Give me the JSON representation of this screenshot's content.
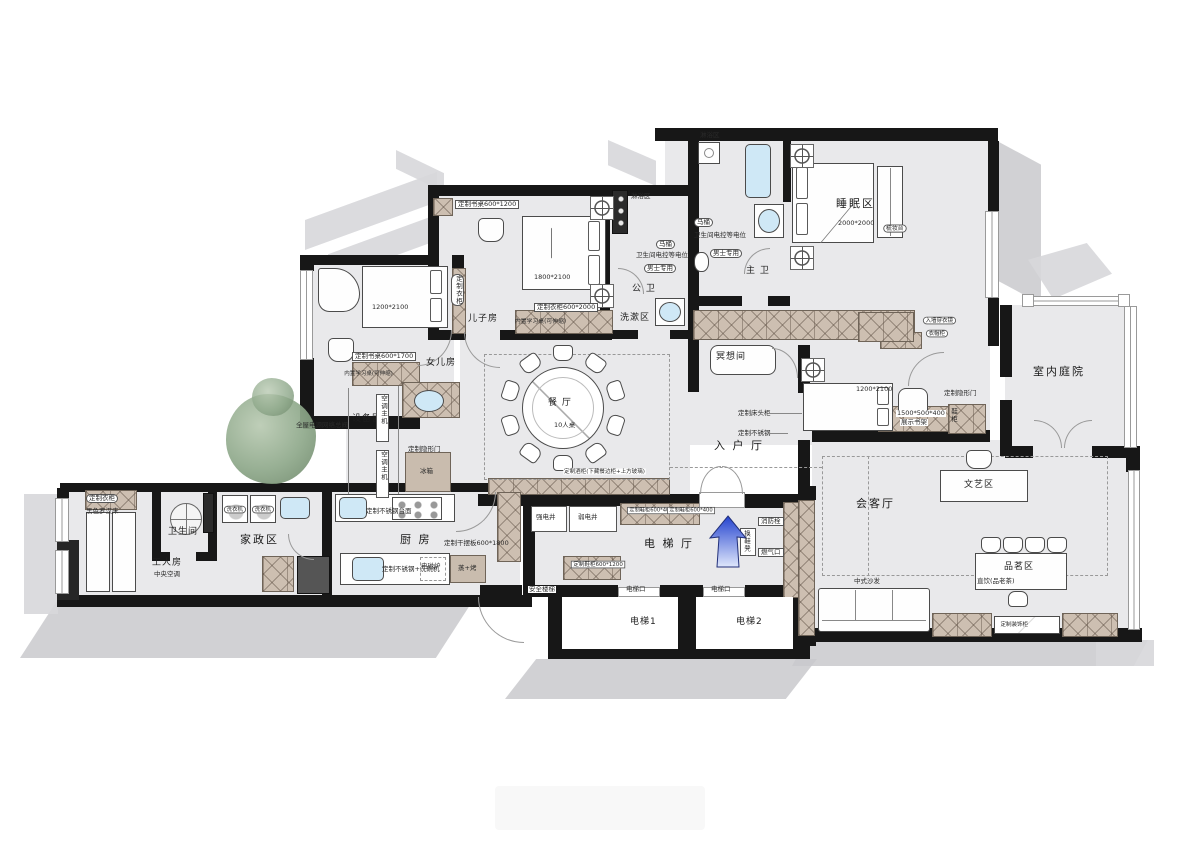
{
  "title": "户型平面布置图",
  "colors": {
    "wall": "#171717",
    "floor": "#e9e9eb",
    "shadow": "#c9c9cd",
    "cabinet_hatch": "#cdbfb1",
    "water_blue": "#cfe8f6",
    "tree_green": "#8ea88a",
    "arrow_blue": "#2443cf",
    "dash_line": "#999999"
  },
  "rooms": {
    "sleeping": {
      "label": "睡眠区",
      "dim": "2000*2000"
    },
    "master_bath": {
      "label": "主 卫"
    },
    "public_bath": {
      "label": "公 卫"
    },
    "wash": {
      "label": "洗漱区"
    },
    "son": {
      "label": "儿子房",
      "bed_dim": "1800*2100"
    },
    "daughter": {
      "label": "女儿房",
      "bed_dim": "1200*2100"
    },
    "equipment": {
      "label": "设备区"
    },
    "dining": {
      "label": "餐 厅",
      "seats": "10人桌"
    },
    "entry": {
      "label": "入 户 厅"
    },
    "meditation": {
      "label": "冥想间"
    },
    "guest_bed": {
      "dim": "1200*2100"
    },
    "living": {
      "label": "会客厅"
    },
    "art": {
      "label": "文艺区"
    },
    "tea": {
      "label": "品茗区",
      "note": "直饮(品老茶)"
    },
    "courtyard": {
      "label": "室内庭院"
    },
    "kitchen": {
      "label": "厨 房"
    },
    "housekeeping": {
      "label": "家政区"
    },
    "maid": {
      "label": "工人房",
      "note": "中央空调"
    },
    "bath_small": {
      "label": "卫生间"
    },
    "hall": {
      "label": "电 梯 厅"
    },
    "elevator1": {
      "label": "电梯1"
    },
    "elevator2": {
      "label": "电梯2"
    },
    "stairs": {
      "label": "安全楼梯"
    }
  },
  "ann": {
    "toilet": "马桶",
    "equipotential": "卫生间电控等电位",
    "men_only": "男士专用",
    "shower": "淋浴区",
    "desk_son": "定制书桌600*1200",
    "wardrobe_son": "定制衣柜600*2000",
    "desk_daughter": "定制书桌600*1700",
    "fold_desk": "内置学习桌(可伸缩)",
    "wardrobe": "定制衣柜",
    "ac_unit": "空调主机",
    "power": "全屋电源网络总阀",
    "hidden_door": "定制隐形门",
    "fridge": "冰箱",
    "dry_rack": "定制干摆板600*1800",
    "sink_cab": "定制不锈钢+洗碗机",
    "induction": "电磁炉",
    "steam_oven": "蒸+烤",
    "counter": "定制不锈钢台面",
    "washer": "洗衣机",
    "black_daybed": "黑色罗汉床",
    "strong_shaft": "强电井",
    "weak_shaft": "弱电井",
    "elevator_door": "电梯口",
    "fire_hydrant": "消防栓",
    "gas_port": "燃气口",
    "shoe_bench": "换鞋凳",
    "shoe_cab": "定制鞋柜600*1200",
    "shoe_cab_small": "定制鞋柜600*400",
    "bedside": "定制床头柜",
    "stainless": "定制不锈钢",
    "bookshelf_dim": "1500*500*400",
    "bookshelf_name": "展示书架",
    "mirror": "入墙穿衣镜",
    "dresser": "梳妆台",
    "wardrobe_box": "衣帽柜",
    "shoe_v": "鞋柜",
    "wine_cab": "定制酒柜(下藏餐边柜+上方玻璃)",
    "sofa": "中式沙发",
    "deco_cab": "定制装饰柜"
  }
}
